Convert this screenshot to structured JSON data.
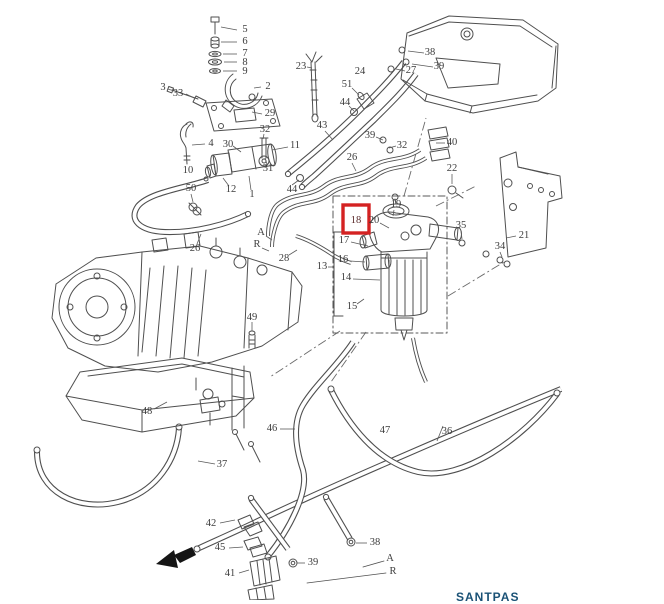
{
  "page": {
    "background": "#ffffff",
    "line_color": "#4f4f4f",
    "watermark": {
      "text": "SANTPAS",
      "color": "#1a5276"
    }
  },
  "diagram": {
    "type": "exploded-parts-diagram",
    "description": "Exploded parts diagram of a diesel fuel system: fuel tank, fuel filter / water separator assembly, injection pump, fuel pipes, hoses and clamps with numbered callouts",
    "highlighted_part": "18",
    "highlight_color": "#d42222",
    "highlight_box": {
      "x": 343,
      "y": 205,
      "width": 26,
      "height": 28
    },
    "labels": [
      {
        "text": "5",
        "x": 245,
        "y": 30
      },
      {
        "text": "6",
        "x": 245,
        "y": 42
      },
      {
        "text": "7",
        "x": 245,
        "y": 54
      },
      {
        "text": "8",
        "x": 245,
        "y": 63
      },
      {
        "text": "9",
        "x": 245,
        "y": 72
      },
      {
        "text": "2",
        "x": 268,
        "y": 87
      },
      {
        "text": "3",
        "x": 163,
        "y": 88
      },
      {
        "text": "33",
        "x": 178,
        "y": 94
      },
      {
        "text": "29",
        "x": 270,
        "y": 114
      },
      {
        "text": "32",
        "x": 265,
        "y": 130
      },
      {
        "text": "4",
        "x": 211,
        "y": 144
      },
      {
        "text": "30",
        "x": 228,
        "y": 145
      },
      {
        "text": "11",
        "x": 295,
        "y": 146
      },
      {
        "text": "31",
        "x": 268,
        "y": 169
      },
      {
        "text": "10",
        "x": 188,
        "y": 171
      },
      {
        "text": "50",
        "x": 191,
        "y": 189
      },
      {
        "text": "12",
        "x": 231,
        "y": 190
      },
      {
        "text": "1",
        "x": 252,
        "y": 195
      },
      {
        "text": "44",
        "x": 292,
        "y": 190
      },
      {
        "text": "23",
        "x": 301,
        "y": 67
      },
      {
        "text": "24",
        "x": 360,
        "y": 72
      },
      {
        "text": "51",
        "x": 347,
        "y": 85
      },
      {
        "text": "44",
        "x": 345,
        "y": 103
      },
      {
        "text": "43",
        "x": 322,
        "y": 126
      },
      {
        "text": "26",
        "x": 352,
        "y": 158
      },
      {
        "text": "38",
        "x": 430,
        "y": 53
      },
      {
        "text": "39",
        "x": 439,
        "y": 67
      },
      {
        "text": "27",
        "x": 411,
        "y": 71
      },
      {
        "text": "39",
        "x": 370,
        "y": 136
      },
      {
        "text": "32",
        "x": 402,
        "y": 146
      },
      {
        "text": "40",
        "x": 452,
        "y": 143
      },
      {
        "text": "22",
        "x": 452,
        "y": 169
      },
      {
        "text": "35",
        "x": 461,
        "y": 226
      },
      {
        "text": "21",
        "x": 524,
        "y": 236
      },
      {
        "text": "34",
        "x": 500,
        "y": 247
      },
      {
        "text": "19",
        "x": 396,
        "y": 205
      },
      {
        "text": "20",
        "x": 374,
        "y": 221
      },
      {
        "text": "18",
        "x": 356,
        "y": 221,
        "highlight": true
      },
      {
        "text": "17",
        "x": 344,
        "y": 241
      },
      {
        "text": "16",
        "x": 343,
        "y": 260
      },
      {
        "text": "13",
        "x": 322,
        "y": 267
      },
      {
        "text": "14",
        "x": 346,
        "y": 278
      },
      {
        "text": "15",
        "x": 352,
        "y": 307
      },
      {
        "text": "26",
        "x": 195,
        "y": 249
      },
      {
        "text": "28",
        "x": 284,
        "y": 259
      },
      {
        "text": "A",
        "x": 261,
        "y": 233
      },
      {
        "text": "R",
        "x": 257,
        "y": 245
      },
      {
        "text": "49",
        "x": 252,
        "y": 318
      },
      {
        "text": "48",
        "x": 147,
        "y": 412
      },
      {
        "text": "46",
        "x": 272,
        "y": 429
      },
      {
        "text": "47",
        "x": 385,
        "y": 431
      },
      {
        "text": "36",
        "x": 447,
        "y": 432
      },
      {
        "text": "37",
        "x": 222,
        "y": 465
      },
      {
        "text": "42",
        "x": 211,
        "y": 524
      },
      {
        "text": "45",
        "x": 220,
        "y": 548
      },
      {
        "text": "41",
        "x": 230,
        "y": 574
      },
      {
        "text": "39",
        "x": 313,
        "y": 563
      },
      {
        "text": "38",
        "x": 375,
        "y": 543
      },
      {
        "text": "A",
        "x": 390,
        "y": 559
      },
      {
        "text": "R",
        "x": 393,
        "y": 572
      }
    ]
  }
}
